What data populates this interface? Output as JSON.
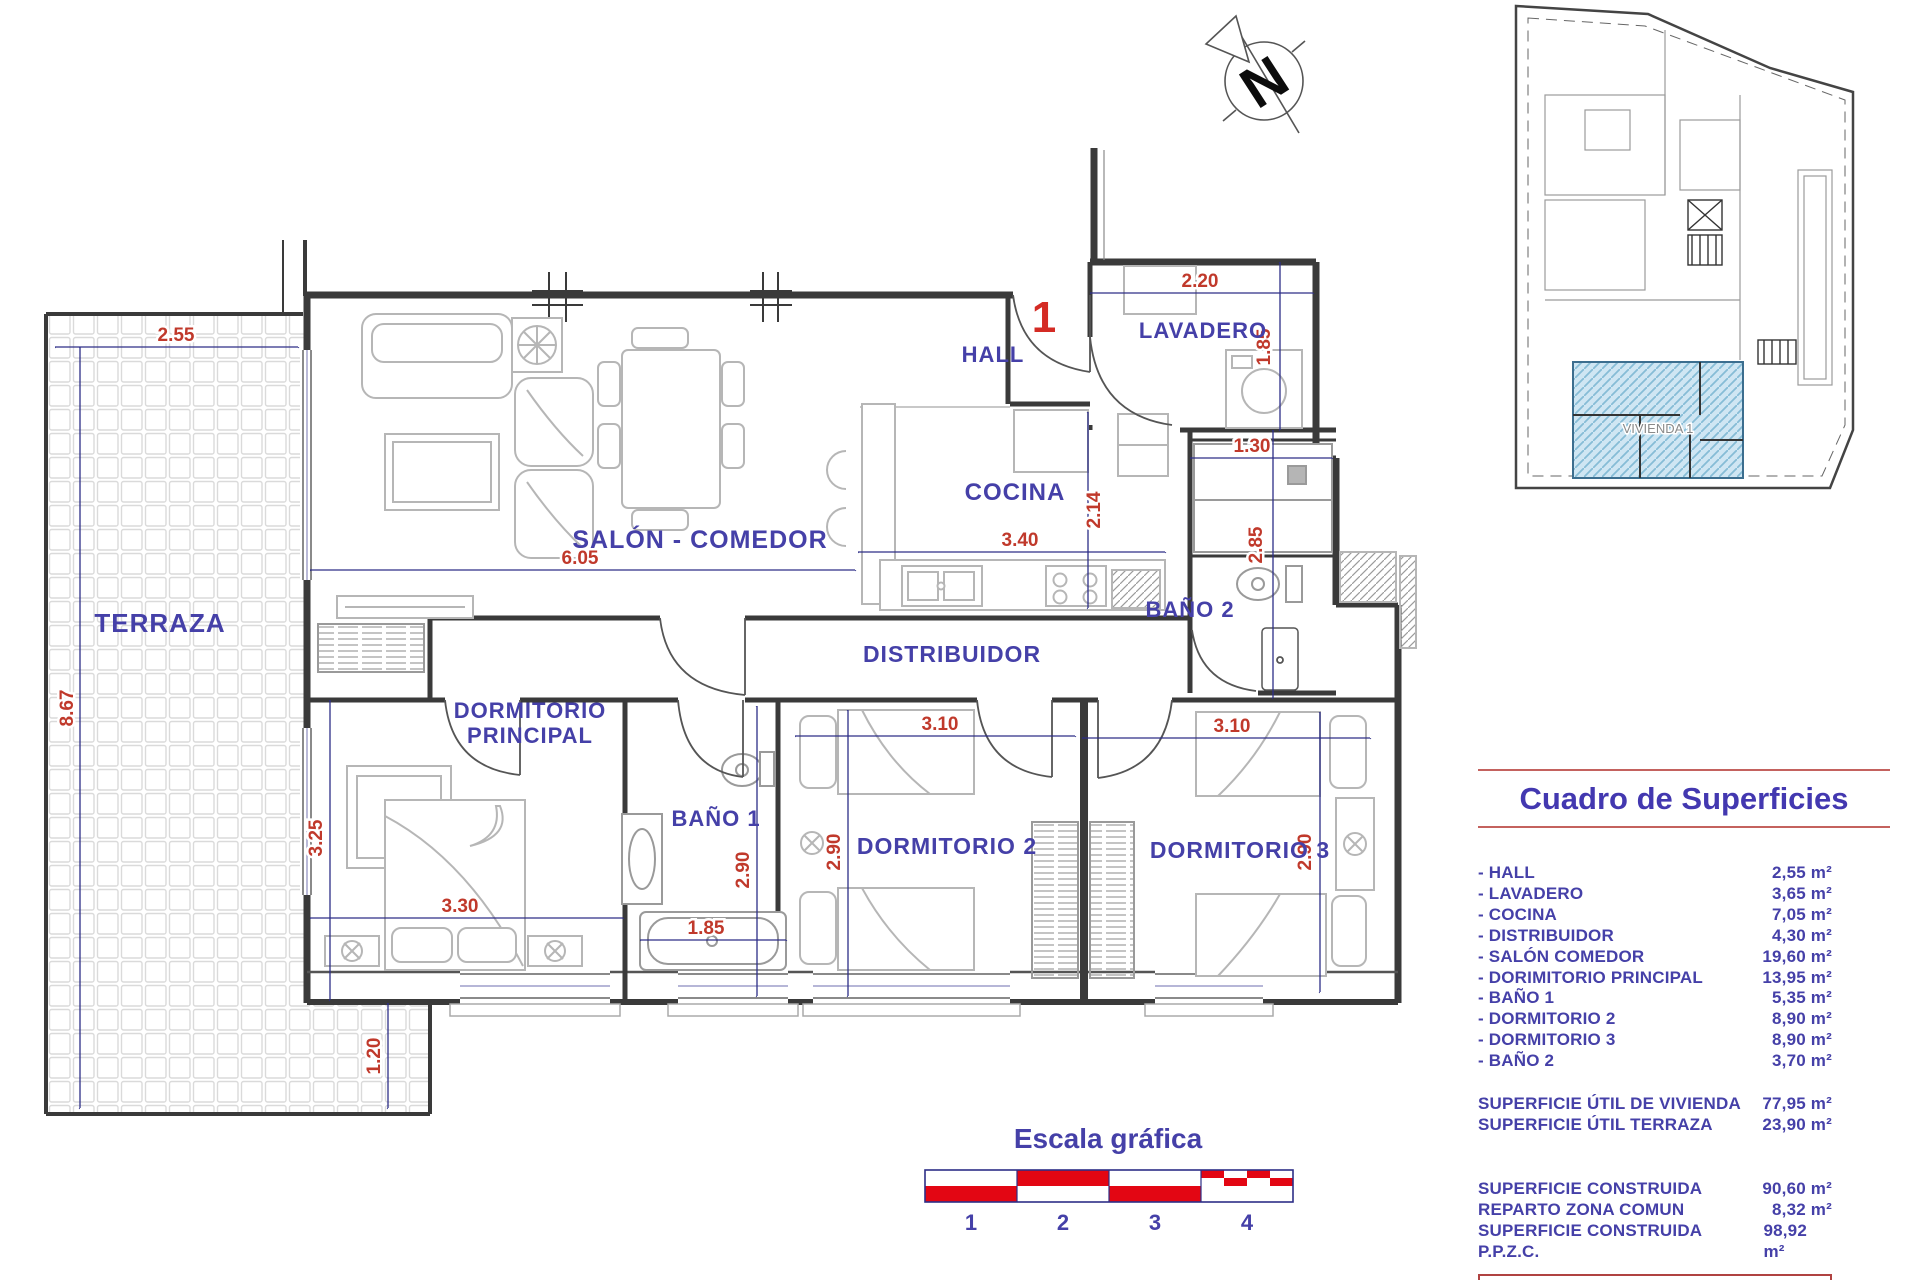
{
  "plan": {
    "unit_number": "1",
    "rooms": {
      "terraza": "TERRAZA",
      "salon_comedor": "SALÓN - COMEDOR",
      "hall": "HALL",
      "lavadero": "LAVADERO",
      "cocina": "COCINA",
      "bano2": "BAÑO 2",
      "distribuidor": "DISTRIBUIDOR",
      "dormitorio_principal_l1": "DORMITORIO",
      "dormitorio_principal_l2": "PRINCIPAL",
      "bano1": "BAÑO 1",
      "dormitorio2": "DORMITORIO 2",
      "dormitorio3": "DORMITORIO 3"
    },
    "dims": {
      "terraza_width": "2.55",
      "terraza_height": "8.67",
      "terraza_strip": "1.20",
      "salon_width": "6.05",
      "dorm_ppal_height": "3.25",
      "dorm_ppal_width": "3.30",
      "bano1_width": "1.85",
      "bano1_height": "2.90",
      "dorm2_width": "3.10",
      "dorm2_height": "2.90",
      "dorm3_width": "3.10",
      "dorm3_height": "2.90",
      "entrance_width": "2.20",
      "lavadero_height": "1.85",
      "cocina_width": "3.40",
      "cocina_height": "2.14",
      "closet_width": "1.30",
      "bano2_height": "2.85"
    }
  },
  "compass": {
    "letter": "N"
  },
  "keyplan": {
    "unit_label": "VIVIENDA 1"
  },
  "scale_bar": {
    "title": "Escala gráfica",
    "ticks": [
      "1",
      "2",
      "3",
      "4"
    ]
  },
  "surfaces_table": {
    "title": "Cuadro de Superficies",
    "rooms": [
      {
        "label": "- HALL",
        "value": "2,55 m²"
      },
      {
        "label": "- LAVADERO",
        "value": "3,65 m²"
      },
      {
        "label": "- COCINA",
        "value": "7,05 m²"
      },
      {
        "label": "- DISTRIBUIDOR",
        "value": "4,30 m²"
      },
      {
        "label": "- SALÓN COMEDOR",
        "value": "19,60 m²"
      },
      {
        "label": "- DORIMITORIO PRINCIPAL",
        "value": "13,95 m²"
      },
      {
        "label": "- BAÑO 1",
        "value": "5,35 m²"
      },
      {
        "label": "- DORMITORIO 2",
        "value": "8,90 m²"
      },
      {
        "label": "- DORMITORIO 3",
        "value": "8,90 m²"
      },
      {
        "label": "- BAÑO 2",
        "value": "3,70 m²"
      }
    ],
    "utiles": [
      {
        "label": "SUPERFICIE ÚTIL DE VIVIENDA",
        "value": "77,95 m²"
      },
      {
        "label": "SUPERFICIE ÚTIL TERRAZA",
        "value": "23,90 m²"
      }
    ],
    "construidas": [
      {
        "label": "SUPERFICIE CONSTRUIDA",
        "value": "90,60 m²"
      },
      {
        "label": "REPARTO ZONA COMUN",
        "value": "8,32 m²"
      },
      {
        "label": "SUPERFICIE CONSTRUIDA P.P.Z.C.",
        "value": "98,92 m²"
      }
    ],
    "total": {
      "label": "SUPERFICIE TOTAL",
      "value": "122,82 m²"
    }
  },
  "colors": {
    "accent_blue": "#4540a8",
    "dim_red": "#c0392b",
    "scale_red": "#e30613",
    "wall": "#3a3a3a",
    "highlight_blue": "#cfe6f3"
  }
}
